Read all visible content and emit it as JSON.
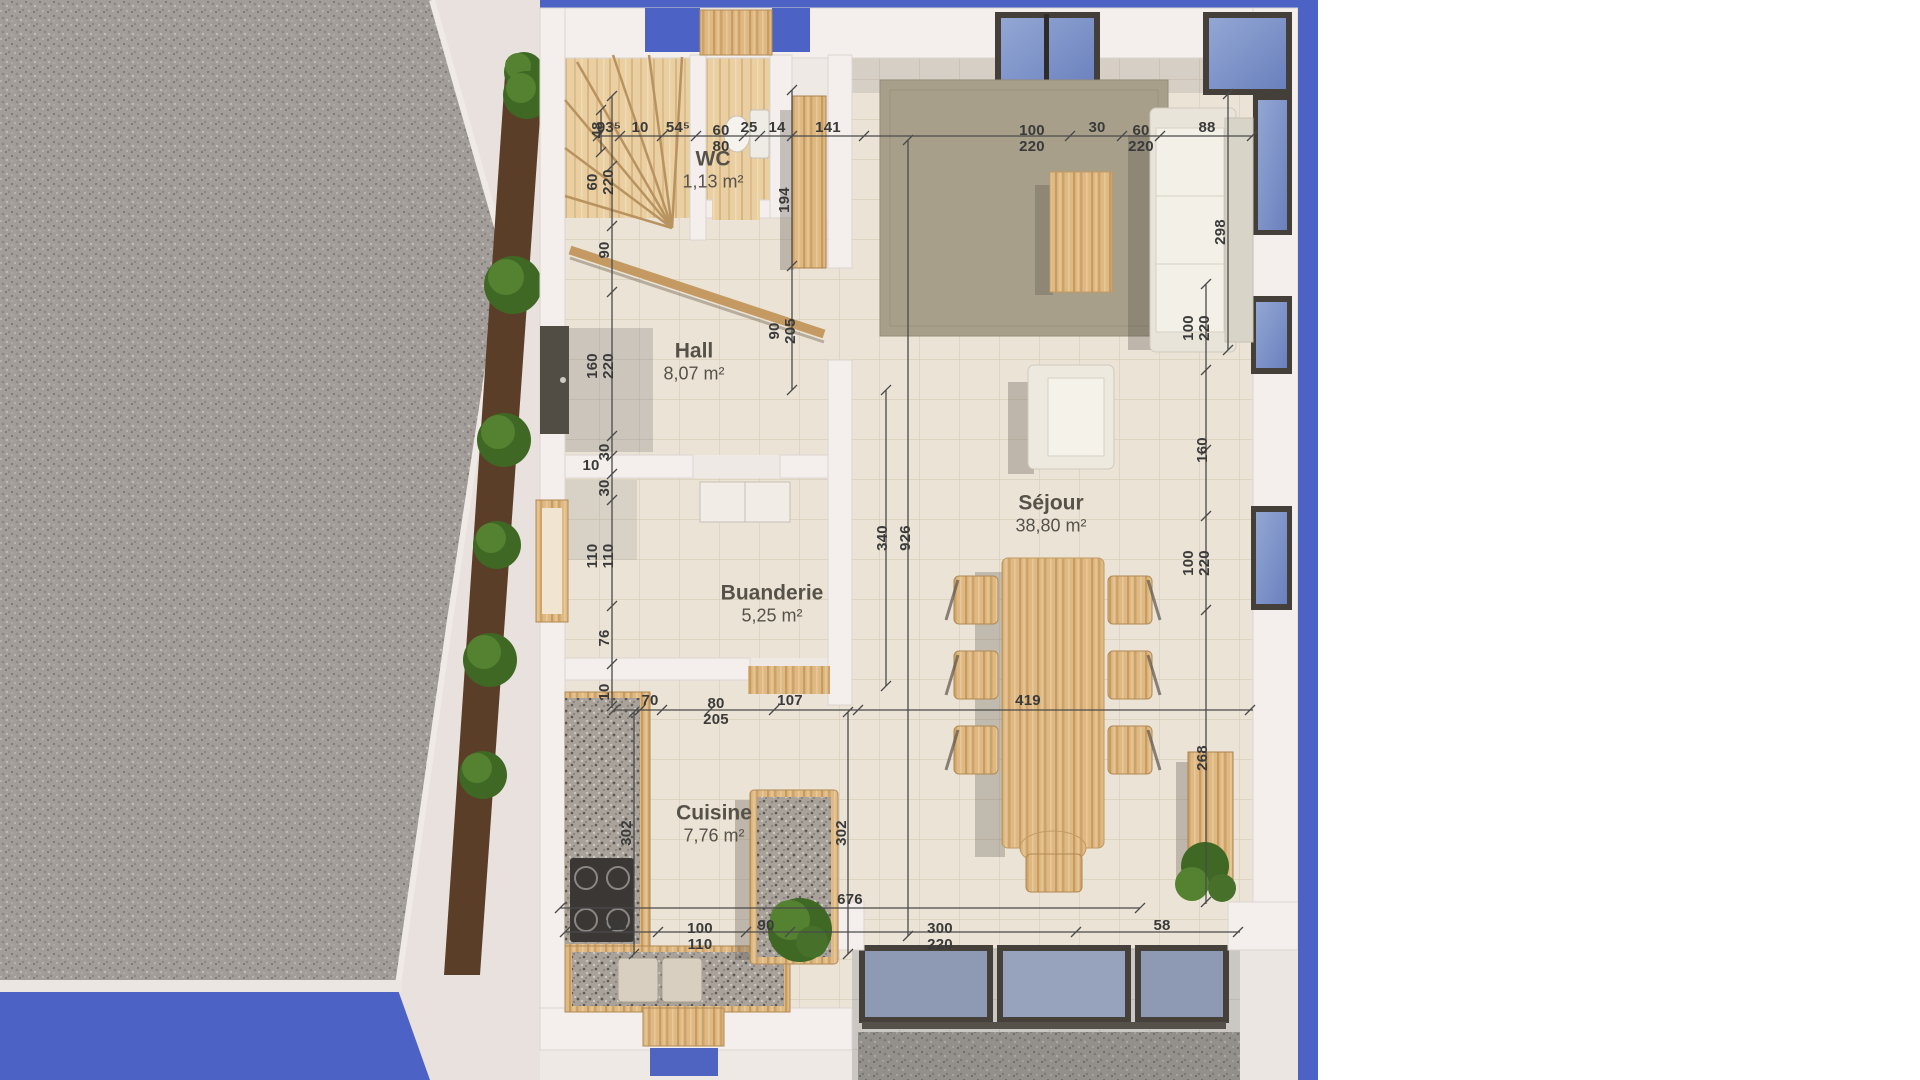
{
  "scene": {
    "type": "floor-plan-render",
    "floor": "ground-floor",
    "language": "fr"
  },
  "rooms": [
    {
      "id": "wc",
      "name": "WC",
      "area": "1,13 m²",
      "x": 713,
      "y": 170
    },
    {
      "id": "hall",
      "name": "Hall",
      "area": "8,07 m²",
      "x": 694,
      "y": 362
    },
    {
      "id": "buanderie",
      "name": "Buanderie",
      "area": "5,25 m²",
      "x": 772,
      "y": 604
    },
    {
      "id": "sejour",
      "name": "Séjour",
      "area": "38,80 m²",
      "x": 1051,
      "y": 514
    },
    {
      "id": "cuisine",
      "name": "Cuisine",
      "area": "7,76 m²",
      "x": 714,
      "y": 824
    }
  ],
  "dimensions": [
    {
      "t": "93⁵",
      "x": 609,
      "y": 128,
      "r": 0
    },
    {
      "t": "10",
      "x": 640,
      "y": 128,
      "r": 0
    },
    {
      "t": "54⁵",
      "x": 678,
      "y": 128,
      "r": 0
    },
    {
      "t": "60\n80",
      "x": 721,
      "y": 139,
      "r": 0
    },
    {
      "t": "25",
      "x": 749,
      "y": 128,
      "r": 0
    },
    {
      "t": "14",
      "x": 777,
      "y": 128,
      "r": 0
    },
    {
      "t": "141",
      "x": 828,
      "y": 128,
      "r": 0
    },
    {
      "t": "100\n220",
      "x": 1032,
      "y": 139,
      "r": 0
    },
    {
      "t": "30",
      "x": 1097,
      "y": 128,
      "r": 0
    },
    {
      "t": "60\n220",
      "x": 1141,
      "y": 139,
      "r": 0
    },
    {
      "t": "88",
      "x": 1207,
      "y": 128,
      "r": 0
    },
    {
      "t": "48",
      "x": 598,
      "y": 130,
      "r": 1
    },
    {
      "t": "60\n220",
      "x": 601,
      "y": 182,
      "r": 1
    },
    {
      "t": "90",
      "x": 605,
      "y": 250,
      "r": 1
    },
    {
      "t": "160\n220",
      "x": 601,
      "y": 366,
      "r": 1
    },
    {
      "t": "30",
      "x": 605,
      "y": 452,
      "r": 1
    },
    {
      "t": "10",
      "x": 591,
      "y": 466,
      "r": 0
    },
    {
      "t": "30",
      "x": 605,
      "y": 488,
      "r": 1
    },
    {
      "t": "110\n110",
      "x": 601,
      "y": 556,
      "r": 1
    },
    {
      "t": "76",
      "x": 605,
      "y": 638,
      "r": 1
    },
    {
      "t": "10",
      "x": 605,
      "y": 692,
      "r": 1
    },
    {
      "t": "194",
      "x": 785,
      "y": 200,
      "r": 1
    },
    {
      "t": "90\n205",
      "x": 783,
      "y": 331,
      "r": 1
    },
    {
      "t": "340",
      "x": 883,
      "y": 538,
      "r": 1
    },
    {
      "t": "926",
      "x": 906,
      "y": 538,
      "r": 1
    },
    {
      "t": "302",
      "x": 627,
      "y": 833,
      "r": 1
    },
    {
      "t": "302",
      "x": 842,
      "y": 833,
      "r": 1
    },
    {
      "t": "298",
      "x": 1221,
      "y": 232,
      "r": 1
    },
    {
      "t": "70",
      "x": 650,
      "y": 701,
      "r": 0
    },
    {
      "t": "80\n205",
      "x": 716,
      "y": 712,
      "r": 0
    },
    {
      "t": "107",
      "x": 790,
      "y": 701,
      "r": 0
    },
    {
      "t": "419",
      "x": 1028,
      "y": 701,
      "r": 0
    },
    {
      "t": "676",
      "x": 850,
      "y": 900,
      "r": 0
    },
    {
      "t": "128",
      "x": 614,
      "y": 926,
      "r": 0
    },
    {
      "t": "100\n110",
      "x": 700,
      "y": 937,
      "r": 0
    },
    {
      "t": "90",
      "x": 766,
      "y": 926,
      "r": 0
    },
    {
      "t": "300\n220",
      "x": 940,
      "y": 937,
      "r": 0
    },
    {
      "t": "58",
      "x": 1162,
      "y": 926,
      "r": 0
    },
    {
      "t": "100\n220",
      "x": 1197,
      "y": 328,
      "r": 1
    },
    {
      "t": "160",
      "x": 1203,
      "y": 450,
      "r": 1
    },
    {
      "t": "100\n220",
      "x": 1197,
      "y": 563,
      "r": 1
    },
    {
      "t": "268",
      "x": 1203,
      "y": 758,
      "r": 1
    }
  ],
  "colors": {
    "backdrop_blue": "#4c63c5",
    "wall_white": "#f2ecea",
    "floor_tile": "#ebe3d5",
    "wood": "#dfb984",
    "wood_floor": "#e9cfa2",
    "granite": "#aaa49d",
    "rug": "#a79f89",
    "gravel": "#a5a09c",
    "terrace_tile": "#cbc7c3",
    "mulch": "#5b3e28",
    "bush_green": "#4c7a2e",
    "frame_dark": "#45413a",
    "dim_text": "#3a3a3a"
  }
}
